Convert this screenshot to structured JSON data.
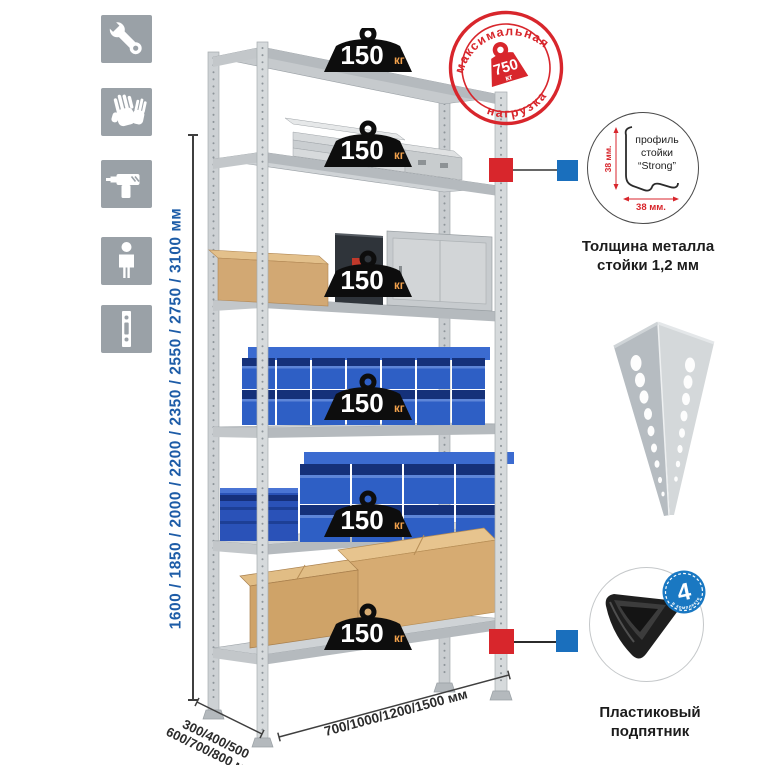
{
  "colors": {
    "accent_red": "#d8262c",
    "accent_blue": "#1a6fbd",
    "dim_text_blue": "#1d5ca7",
    "icon_gray": "#9aa1a7",
    "badge_black": "#0d0d0d",
    "unit_orange": "#f2a14c",
    "bin_blue": "#2e5fc5",
    "metal_light": "#d3d6d8"
  },
  "sidebar": {
    "icons": [
      {
        "name": "wrench-icon"
      },
      {
        "name": "gloves-icon"
      },
      {
        "name": "drill-icon"
      },
      {
        "name": "person-icon"
      },
      {
        "name": "rack-profile-icon"
      }
    ]
  },
  "height_dimension": {
    "label": "1600 / 1850 / 2000 / 2200 / 2350 / 2550 / 2750 / 3100 мм"
  },
  "rack": {
    "shelf_count": 6,
    "load_badge": {
      "value": "150",
      "unit": "кг"
    }
  },
  "max_load_stamp": {
    "arc_top": "максимальная",
    "arc_bottom": "нагрузка",
    "value": "750",
    "unit": "кг"
  },
  "profile_detail": {
    "label_line1": "профиль",
    "label_line2": "стойки",
    "label_line3": "“Strong”",
    "dim_vertical": "38 мм.",
    "dim_horizontal": "38 мм.",
    "caption_line1": "Толщина металла",
    "caption_line2": "стойки 1,2 мм"
  },
  "foot_detail": {
    "badge_value": "4",
    "badge_arc_text": "в комплекте",
    "caption_line1": "Пластиковый",
    "caption_line2": "подпятник"
  },
  "depth_dimension": {
    "line1": "300/400/500",
    "line2": "600/700/800 мм"
  },
  "width_dimension": {
    "label": "700/1000/1200/1500 мм"
  }
}
